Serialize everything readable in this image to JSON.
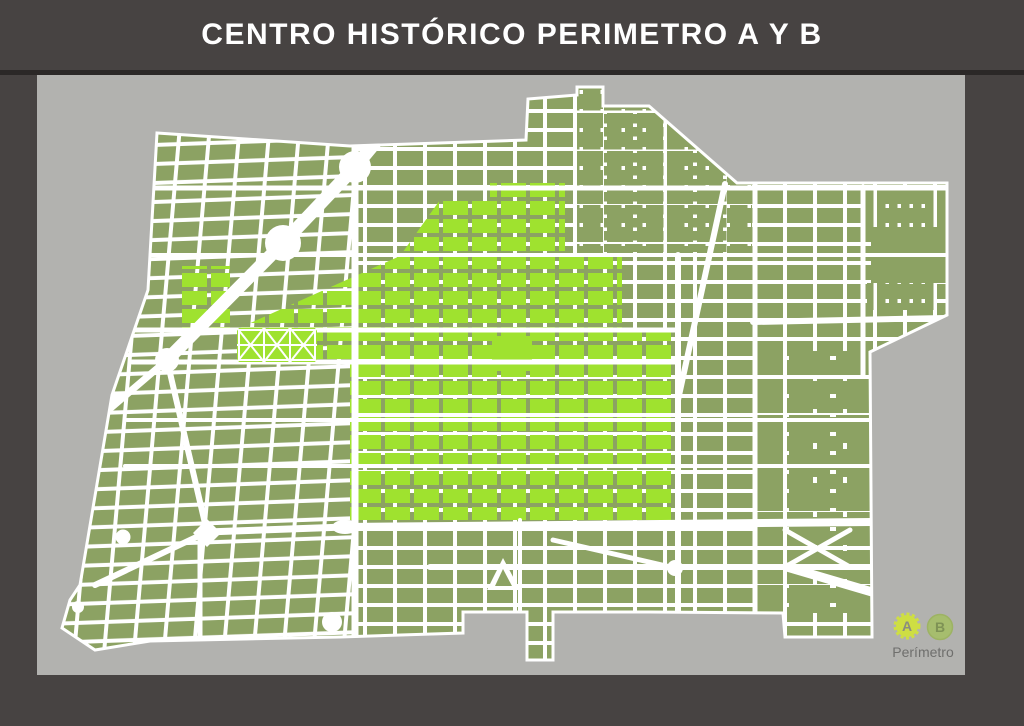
{
  "header": {
    "title": "CENTRO HISTÓRICO PERIMETRO A Y B"
  },
  "legend": {
    "a_label": "A",
    "b_label": "B",
    "caption": "Perímetro"
  },
  "colors": {
    "header_bg": "#474342",
    "page_bg": "#474342",
    "separator": "#2b2827",
    "panel_bg": "#b2b2af",
    "street": "#ffffff",
    "perimeter_a": "#9fe22f",
    "perimeter_b": "#8ca263",
    "legend_a_badge": "#cede43",
    "legend_a_text": "#8a8d80",
    "legend_b_badge": "#a6bd6e",
    "legend_b_text": "#7e9255",
    "legend_caption_text": "#6f6f6d"
  }
}
